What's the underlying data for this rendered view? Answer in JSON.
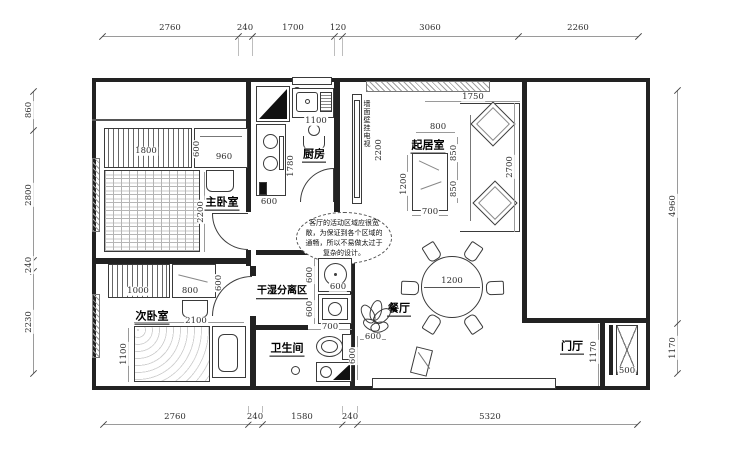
{
  "rooms": {
    "master_bedroom": "主卧室",
    "second_bedroom": "次卧室",
    "kitchen": "厨房",
    "living_room": "起居室",
    "dry_wet_area": "干湿分离区",
    "bathroom": "卫生间",
    "dining_room": "餐厅",
    "entry_hall": "门厅"
  },
  "notes": {
    "living_room_note": "客厅的活动区域应很宽敞，为保证到各个区域的通畅，所以不易做太过于复杂的设计。",
    "tv_wall_note": "墙面壁挂电视"
  },
  "dimensions": {
    "top": [
      "2760",
      "240",
      "1700",
      "120",
      "3060",
      "2260"
    ],
    "bottom": [
      "2760",
      "240",
      "1580",
      "240",
      "5320"
    ],
    "left": [
      "860",
      "2800",
      "240",
      "2230"
    ],
    "right": [
      "4960",
      "1170"
    ],
    "interior": {
      "wardrobe_master_width": "1800",
      "wardrobe_master_depth": "600",
      "dresser_width": "960",
      "bed_master_length": "2200",
      "kitchen_sink": "1100",
      "kitchen_counter_length": "1780",
      "kitchen_counter_depth": "600",
      "tv_wall_height": "2200",
      "sofa_width": "1750",
      "sofa_offset": "800",
      "sofa_seat_a": "850",
      "sofa_seat_b": "850",
      "sofa_length": "2700",
      "tv_stand_length": "1200",
      "tv_stand_width": "700",
      "wardrobe_second_width": "1000",
      "desk_width": "800",
      "desk_depth": "600",
      "bed_second_length": "2100",
      "bed_second_width": "1100",
      "basin_depth": "600",
      "basin_width": "600",
      "washer_depth": "600",
      "bath_opening": "700",
      "bath_counter": "600",
      "plant_width": "600",
      "dining_table_diameter": "1200",
      "entry_depth": "1170",
      "entry_cabinet": "500"
    }
  }
}
